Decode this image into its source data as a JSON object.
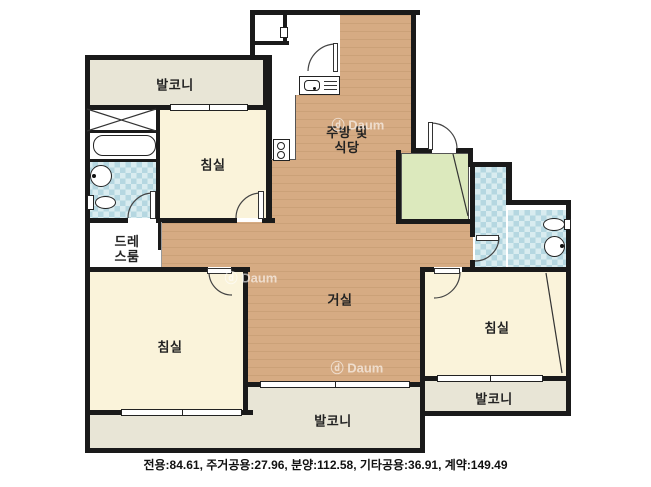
{
  "labels": {
    "balcony_top": "발코니",
    "bedroom_top_left": "침실",
    "kitchen_line1": "주방 및",
    "kitchen_line2": "식당",
    "dressroom_line1": "드레",
    "dressroom_line2": "스룸",
    "living_room": "거실",
    "bedroom_bottom_left": "침실",
    "bedroom_right": "침실",
    "balcony_bottom": "발코니",
    "balcony_right": "발코니"
  },
  "watermark": {
    "text": "ⓓ Daum"
  },
  "caption": {
    "text": "전용:84.61, 주거공용:27.96, 분양:112.58, 기타공용:36.91, 계약:149.49"
  },
  "icons": [
    "door-icon",
    "window-icon",
    "bathtub-icon",
    "toilet-icon",
    "sink-icon",
    "stove-icon",
    "closet-x-icon",
    "folding-door-icon"
  ],
  "colors": {
    "wall": "#1a1a1a",
    "wood": "#d6ab83",
    "wood_stripe": "#cba178",
    "cream": "#faf3da",
    "balcony": "#e8e5d6",
    "tile": "#d9ecf0",
    "tile_square": "#b5d7e1",
    "green": "#dce9bd",
    "text": "#222222"
  }
}
